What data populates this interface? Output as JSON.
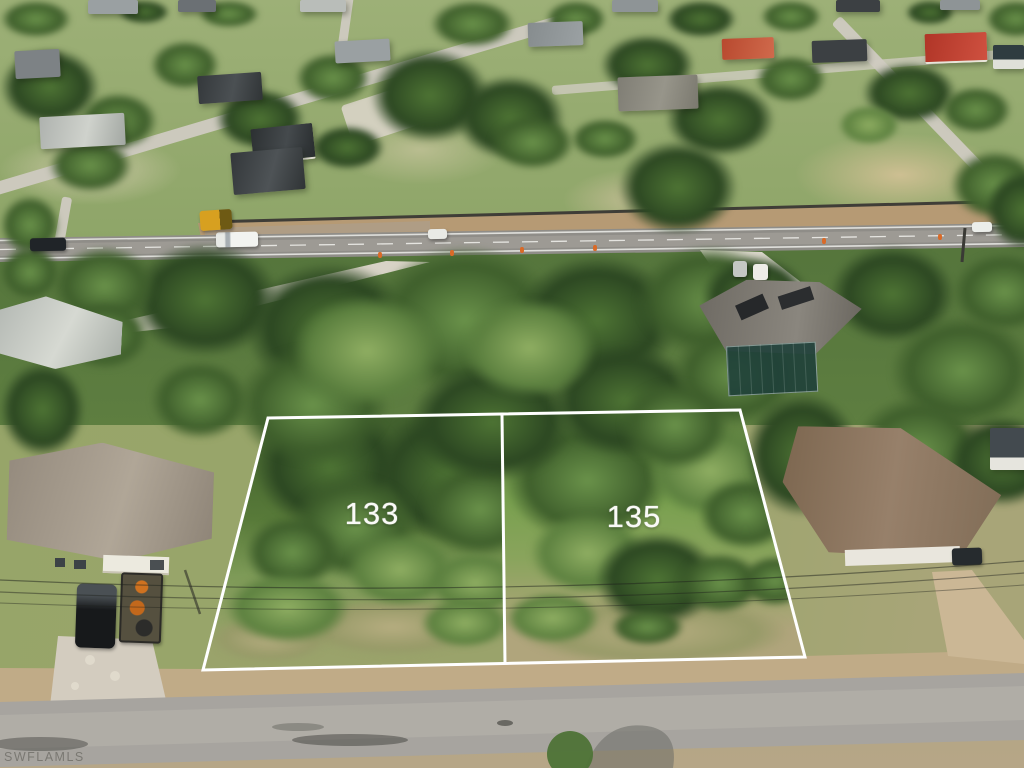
{
  "image": {
    "kind": "aerial drone photo",
    "scene": "residential neighborhood with two vacant lots outlined in white between homes, a main road above and a street below"
  },
  "overlay": {
    "outline_color": "#ffffff",
    "lots": [
      {
        "label": "133"
      },
      {
        "label": "135"
      }
    ]
  },
  "watermark": {
    "text": "SWFLAMLS",
    "color": "rgba(95,93,87,0.62)"
  }
}
